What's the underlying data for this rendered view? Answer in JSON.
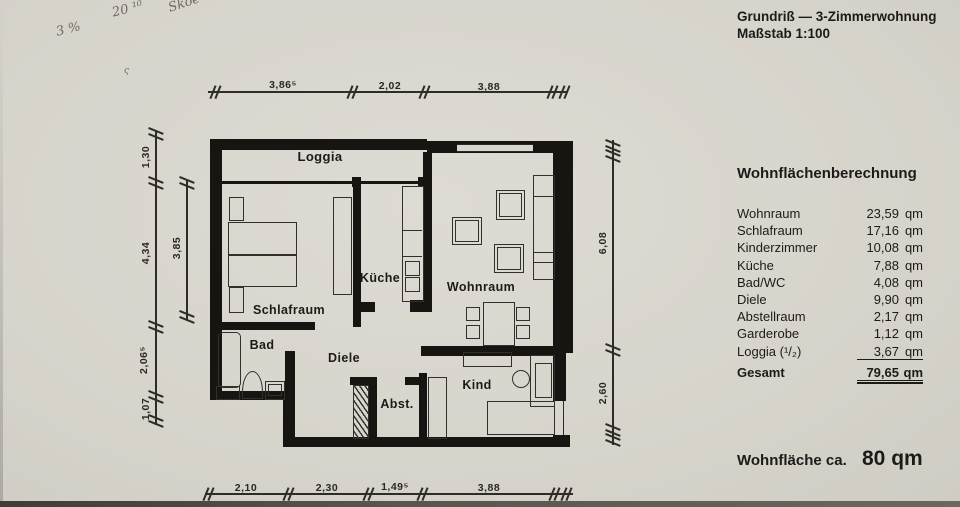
{
  "header": {
    "title": "Grundriß — 3-Zimmerwohnung",
    "scale": "Maßstab 1:100"
  },
  "handwriting": {
    "line1": "20 ¹⁰",
    "line2": "Skoe",
    "line3": "3 %",
    "mark": "ς"
  },
  "plan": {
    "room_labels": {
      "loggia": "Loggia",
      "schlafraum": "Schlafraum",
      "kueche": "Küche",
      "wohnraum": "Wohnraum",
      "bad": "Bad",
      "diele": "Diele",
      "abstellraum": "Abst.",
      "kind": "Kind"
    },
    "dimensions": {
      "top": [
        "3,86⁵",
        "2,02",
        "3,88"
      ],
      "bottom": [
        "2,10",
        "2,30",
        "1,49⁵",
        "3,88"
      ],
      "left_outer": [
        "1,30",
        "4,34",
        "2,06⁵",
        "1,07"
      ],
      "left_inner": [
        "3,85"
      ],
      "right": [
        "6,08",
        "2,60"
      ]
    }
  },
  "table": {
    "title": "Wohnflächenberechnung",
    "unit": "qm",
    "rows": [
      {
        "label": "Wohnraum",
        "value": "23,59"
      },
      {
        "label": "Schlafraum",
        "value": "17,16"
      },
      {
        "label": "Kinderzimmer",
        "value": "10,08"
      },
      {
        "label": "Küche",
        "value": "7,88"
      },
      {
        "label": "Bad/WC",
        "value": "4,08"
      },
      {
        "label": "Diele",
        "value": "9,90"
      },
      {
        "label": "Abstellraum",
        "value": "2,17"
      },
      {
        "label": "Garderobe",
        "value": "1,12"
      },
      {
        "label": "Loggia (¹/₂)",
        "value": "3,67",
        "underlined": true
      }
    ],
    "total": {
      "label": "Gesamt",
      "value": "79,65"
    }
  },
  "footer": {
    "label": "Wohnfläche ca.",
    "value": "80 qm"
  }
}
